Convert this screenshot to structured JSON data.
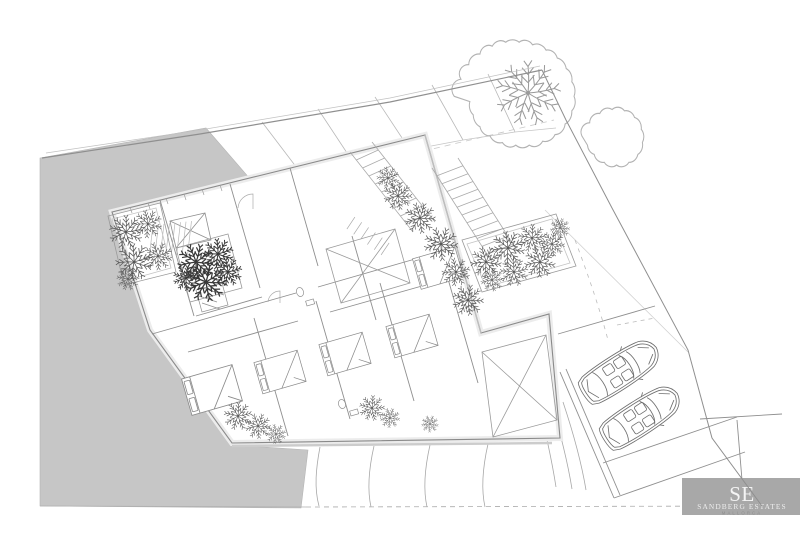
{
  "meta": {
    "kind": "architectural site plan drawing",
    "width": 800,
    "height": 539,
    "background": "#ffffff"
  },
  "logo": {
    "initials": "SE",
    "name": "SANDBERG ESTATES",
    "subtitle": "MALLORCA",
    "bg_color": "#a8a8a8",
    "initials_color": "#f4f4f4",
    "name_color": "#ededed",
    "subtitle_color": "#8e8e8e"
  },
  "palette": {
    "neighbor_parcel": "#c6c6c6",
    "boundary_line": "#8f8f8f",
    "wall_line": "#8a8a8a",
    "wall_band": "#ececec",
    "light_line": "#c2c2c2",
    "stair_line": "#aaaaaa",
    "contour_line": "#a8a8a8",
    "vegetation": "#565656",
    "vegetation_dark": "#383838",
    "car_line": "#6e6e6e",
    "tree_line": "#b2b2b2"
  },
  "elements": {
    "parked_cars": 2,
    "beds": 5,
    "exterior_staircases": 2,
    "planted_areas": 4,
    "large_tree": 1,
    "shaded_neighbor_parcel": 1
  }
}
